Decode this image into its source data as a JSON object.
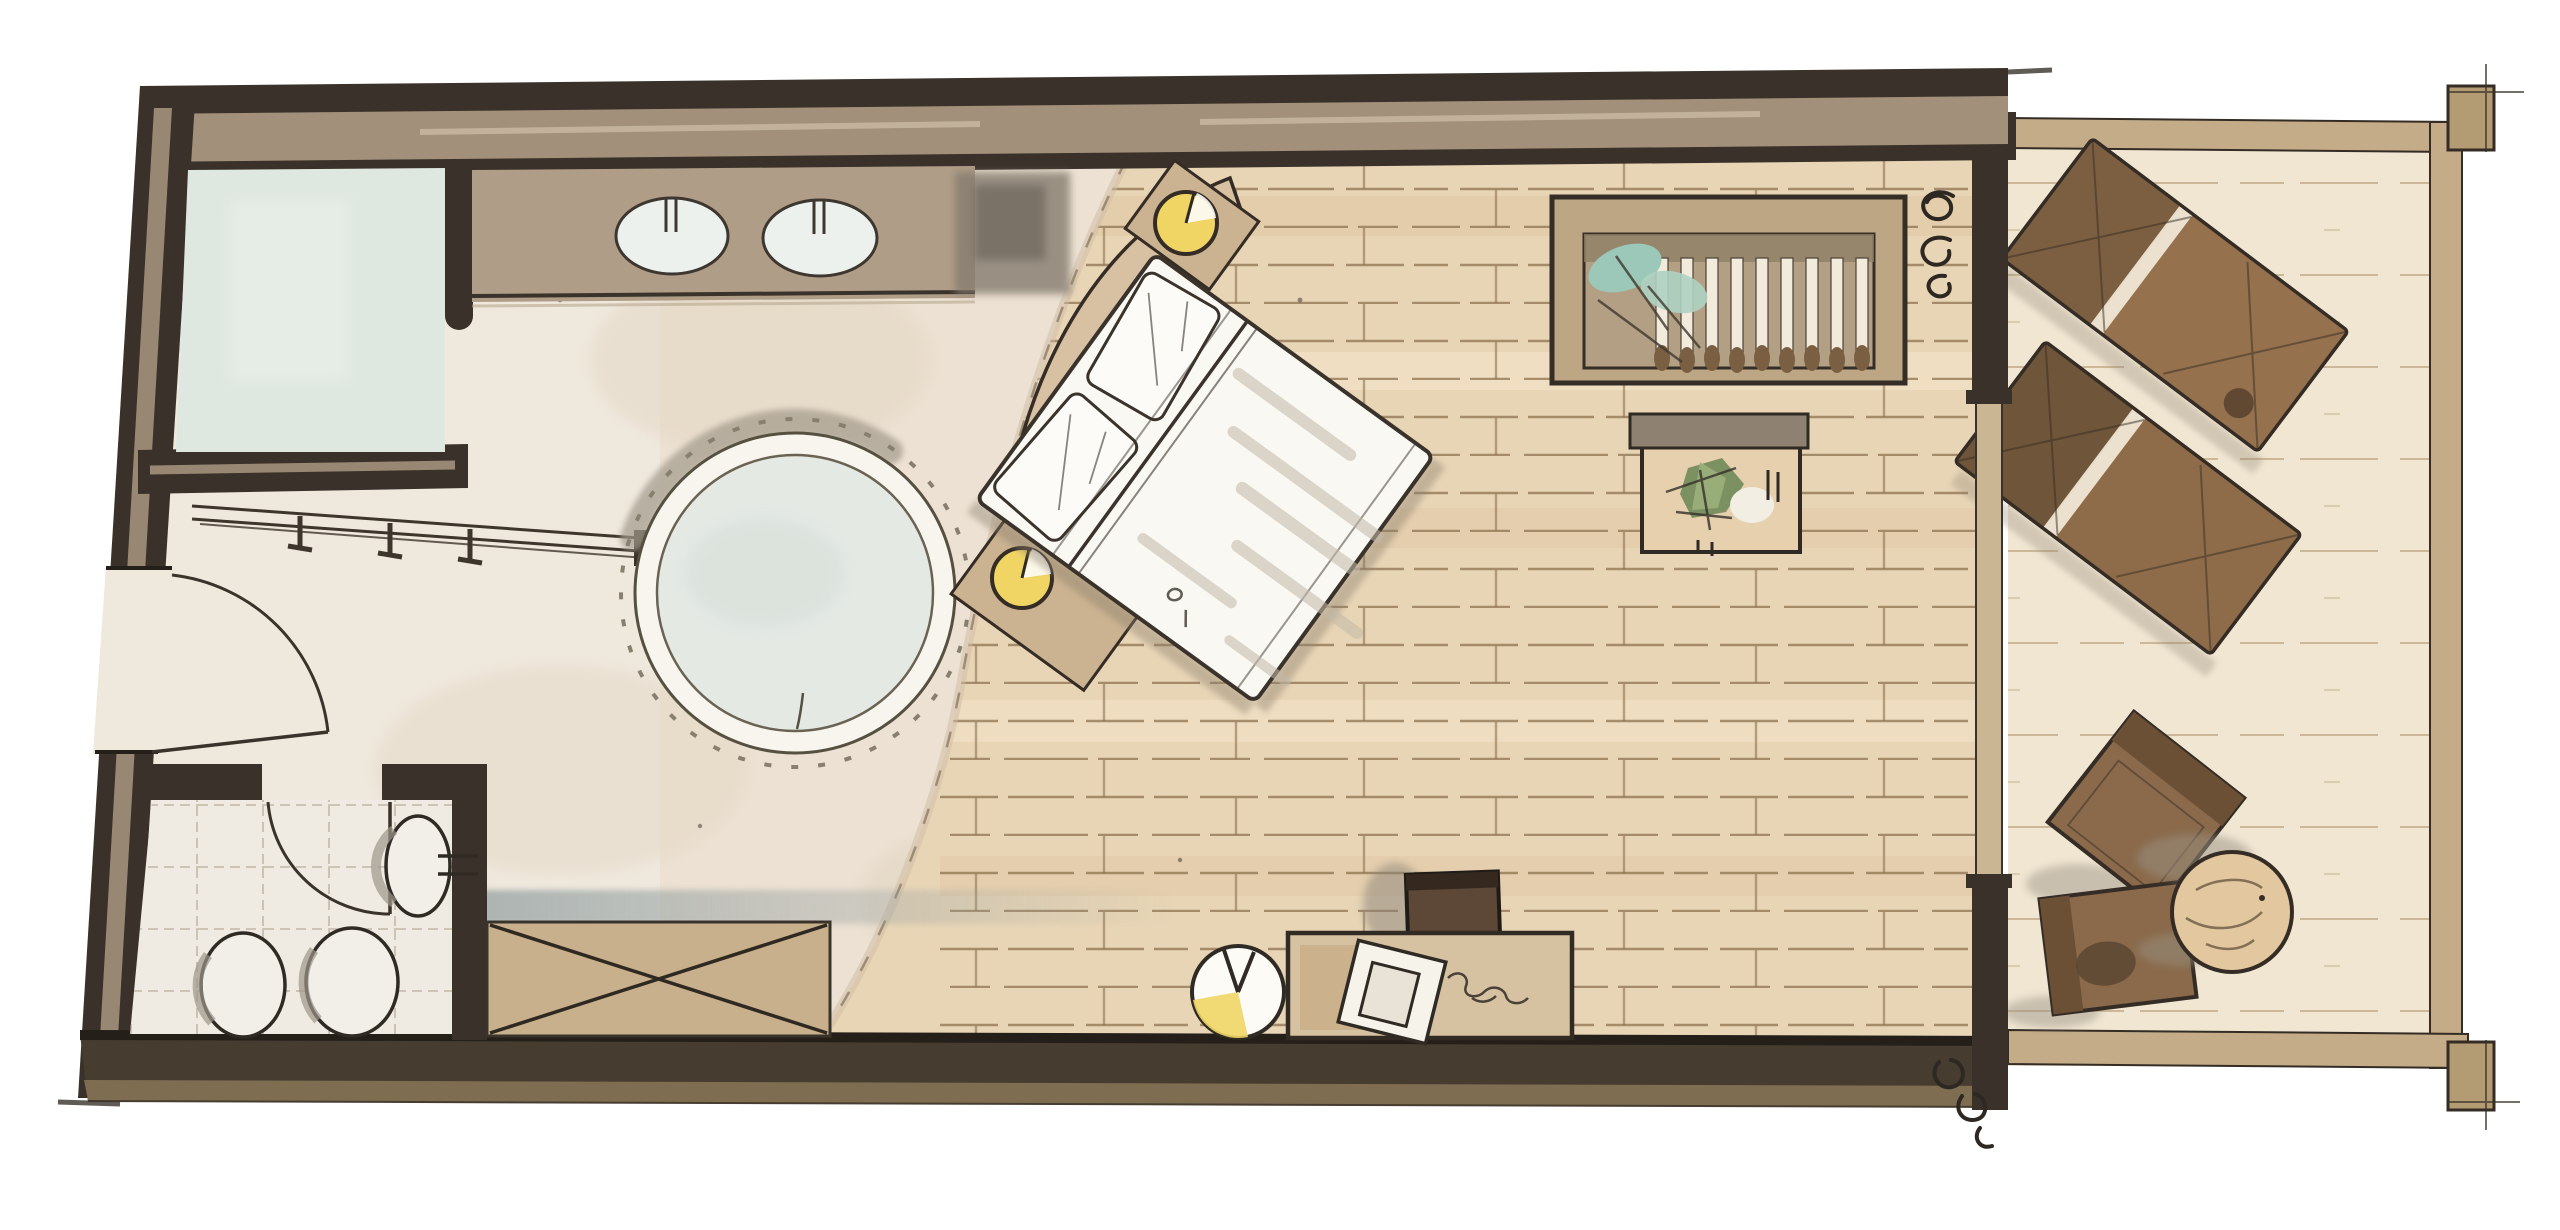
{
  "meta": {
    "kind": "hand-drawn-watercolor-floor-plan",
    "visible_text": []
  },
  "colors": {
    "paper": "#ffffff",
    "wall_dark": "#3a322a",
    "wall_edge": "#241f19",
    "wall_mid": "#a3907b",
    "wall_light": "#cfc0aa",
    "outline": "#352d25",
    "carpet": "#ece1d2",
    "bath_floor": "#efe8dd",
    "shower": "#dfe7e1",
    "tile_line": "#c2b7a8",
    "wood": "#e8d5b6",
    "wood_line": "#8d7350",
    "wood_dark": "#d9bf97",
    "wood_light": "#f4e6cb",
    "counter": "#b09d87",
    "sink": "#edf1ee",
    "gray_wash": "#857c70",
    "headboard": "#d7c1a2",
    "table_tan": "#cbb391",
    "lamp_yellow": "#f0d565",
    "bed_white": "#faf8f2",
    "bed_streak": "#c3baa9",
    "pillow": "#fcfbf7",
    "rug_ring": "#f7f5ee",
    "rug_center": "#e4e9e4",
    "rug_shadow": "#a29a8b",
    "fringe": "#87806f",
    "wardrobe_frame": "#bda684",
    "wardrobe_bg": "#b3a084",
    "wardrobe_shelf": "#8f7f66",
    "slat": "#f2ebdc",
    "knob": "#7a5f42",
    "teal": "#9bc8b8",
    "teal2": "#aed2c2",
    "plant_green": "#7c9161",
    "plant_green2": "#9fb27e",
    "bench": "#c8b08c",
    "smear": "#96a2a3",
    "desk": "#d6c1a1",
    "desk_patch": "#c4a87f",
    "paper_white": "#f6f3ea",
    "chair_dark": "#5d4837",
    "chair_dark_top": "#35291f",
    "glass": "#cbb693",
    "deck": "#f0e6d2",
    "deck_line": "#c6b190",
    "border_tan": "#c3ac87",
    "post": "#b39b74",
    "lounger_frame": "#a8845e",
    "lounger_back": "#7c5f41",
    "lounger_body": "#95714d",
    "lounger2_body": "#8f6c49",
    "chair_brown": "#8a6a4b",
    "chair_back": "#6b5036",
    "side_table": "#e3c79e",
    "grain": "#6b5a42",
    "shadow_gray": "#9a9183",
    "fixture": "#f2efe8",
    "fixture_shade": "#9d958a"
  },
  "plan": {
    "rooms": [
      {
        "id": "bathroom",
        "items": [
          "shower",
          "vanity-with-two-sinks",
          "faucets",
          "coat-rack-with-hooks",
          "entry-door-swing",
          "gray-wash-niche"
        ]
      },
      {
        "id": "wc",
        "items": [
          "wall-hung-toilet",
          "toilet",
          "bidet",
          "flush-plate",
          "wc-door-swing",
          "tiled-floor"
        ]
      },
      {
        "id": "bedroom",
        "items": [
          "double-bed",
          "curved-headboard",
          "pillow-left",
          "pillow-right",
          "bedside-table-upper",
          "bedside-lamp-upper",
          "bedside-table-lower",
          "bedside-lamp-lower",
          "round-fringed-rug",
          "wardrobe-with-hangers",
          "hanging-plant-teal",
          "plant-side-table",
          "desk",
          "desk-paper",
          "desk-chair",
          "cable-squiggle",
          "floor-lamp",
          "storage-bench-x",
          "sliding-glass-door",
          "curtain-mark-top",
          "curtain-mark-bottom",
          "wood-plank-floor",
          "carpet-area"
        ]
      },
      {
        "id": "terrace",
        "items": [
          "deck-boards",
          "railing-border-top",
          "railing-border-right",
          "railing-border-bottom",
          "corner-post-top",
          "corner-post-bottom",
          "sun-lounger-upper",
          "sun-lounger-lower",
          "outdoor-chair-upper",
          "outdoor-chair-lower",
          "round-outdoor-table"
        ]
      }
    ]
  }
}
